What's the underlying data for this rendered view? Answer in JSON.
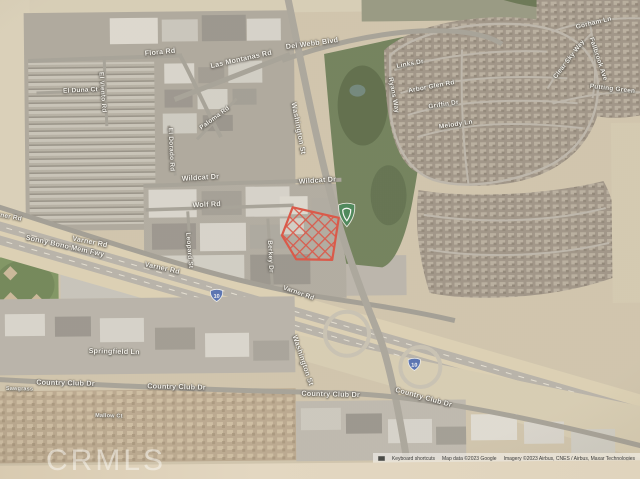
{
  "watermark": "CRMLS",
  "attribution": {
    "keyboard_shortcuts": "Keyboard shortcuts",
    "map_data": "Map data ©2023 Google",
    "imagery": "Imagery ©2023 Airbus, CNES / Airbus, Maxar Technologies"
  },
  "map": {
    "type": "satellite-imagery",
    "shield_label": "10",
    "icons": {
      "interstate_shield": "blue interstate 10 route shield",
      "place_marker": "green shield golf-club place marker",
      "keyboard": "keyboard shortcuts icon"
    },
    "highlighted_parcel": {
      "description": "red cross-hatched parcel outline near Washington St and Varner Rd",
      "color": "#e53c2b"
    },
    "colors": {
      "desert": "#d3c6a9",
      "urban": "#a7a195",
      "golf_green": "#5e7446",
      "freeway": "#ddcfae",
      "marker_green": "#2e7b43",
      "shield_blue": "#3f62b5"
    },
    "road_labels": [
      {
        "text": "Flora Rd",
        "x": 168,
        "y": 54,
        "rot": -5
      },
      {
        "text": "Las Montanas Rd",
        "x": 249,
        "y": 62,
        "rot": -12
      },
      {
        "text": "Del Webb Blvd",
        "x": 320,
        "y": 47,
        "rot": -7
      },
      {
        "text": "El Duna Ct",
        "x": 88,
        "y": 92,
        "rot": -2,
        "size": 6.5
      },
      {
        "text": "El Viento Rd",
        "x": 110,
        "y": 94,
        "rot": 86,
        "size": 6.5
      },
      {
        "text": "El Dorado Rd",
        "x": 178,
        "y": 152,
        "rot": 88,
        "size": 6.5
      },
      {
        "text": "Paloma Rd",
        "x": 222,
        "y": 121,
        "rot": -36,
        "size": 6.5
      },
      {
        "text": "Wildcat Dr",
        "x": 207,
        "y": 180,
        "rot": -3
      },
      {
        "text": "Wildcat Dr",
        "x": 324,
        "y": 184,
        "rot": -3
      },
      {
        "text": "Wolf Rd",
        "x": 213,
        "y": 207,
        "rot": -2
      },
      {
        "text": "Washington St",
        "x": 306,
        "y": 132,
        "rot": 80
      },
      {
        "text": "Washington St",
        "x": 308,
        "y": 364,
        "rot": 72
      },
      {
        "text": "Links Dr",
        "x": 418,
        "y": 69,
        "rot": -10,
        "size": 6.5
      },
      {
        "text": "Arbor Glen Rd",
        "x": 439,
        "y": 92,
        "rot": -10,
        "size": 6.5
      },
      {
        "text": "Griffin Dr",
        "x": 451,
        "y": 110,
        "rot": -8,
        "size": 6.5
      },
      {
        "text": "Melody Ln",
        "x": 463,
        "y": 130,
        "rot": -8,
        "size": 6.5
      },
      {
        "text": "Ryans Way",
        "x": 401,
        "y": 100,
        "rot": 80,
        "size": 6.5
      },
      {
        "text": "Gorham Ln",
        "x": 602,
        "y": 30,
        "rot": -13,
        "size": 6.5
      },
      {
        "text": "Clear Sky Way",
        "x": 577,
        "y": 66,
        "rot": -52,
        "size": 6.5
      },
      {
        "text": "Fallbrook Ave",
        "x": 606,
        "y": 66,
        "rot": 72,
        "size": 6.5
      },
      {
        "text": "Putting Green",
        "x": 620,
        "y": 96,
        "rot": 7,
        "size": 6.5
      },
      {
        "text": "Sonny Bono Mem Fwy",
        "x": 71,
        "y": 247,
        "rot": 13
      },
      {
        "text": "Varner Rd",
        "x": 12,
        "y": 217,
        "rot": 11,
        "size": 6.5
      },
      {
        "text": "Varner Rd",
        "x": 96,
        "y": 243,
        "rot": 12
      },
      {
        "text": "Varner Rd",
        "x": 168,
        "y": 270,
        "rot": 13
      },
      {
        "text": "Varner Rd",
        "x": 304,
        "y": 297,
        "rot": 20,
        "size": 6.5
      },
      {
        "text": "Leopard St",
        "x": 195,
        "y": 253,
        "rot": 86,
        "size": 6.5
      },
      {
        "text": "Berkey Dr",
        "x": 276,
        "y": 260,
        "rot": 88,
        "size": 6.5
      },
      {
        "text": "Springfield Ln",
        "x": 119,
        "y": 353,
        "rot": 2
      },
      {
        "text": "Country Club Dr",
        "x": 70,
        "y": 384,
        "rot": 2
      },
      {
        "text": "Country Club Dr",
        "x": 181,
        "y": 389,
        "rot": 2
      },
      {
        "text": "Country Club Dr",
        "x": 335,
        "y": 398,
        "rot": 2
      },
      {
        "text": "Country Club Dr",
        "x": 428,
        "y": 402,
        "rot": 16
      },
      {
        "text": "Sawgrass",
        "x": 24,
        "y": 390,
        "rot": 2,
        "size": 5.5
      },
      {
        "text": "Mallow Ct",
        "x": 113,
        "y": 418,
        "rot": 2,
        "size": 5.5
      }
    ]
  }
}
